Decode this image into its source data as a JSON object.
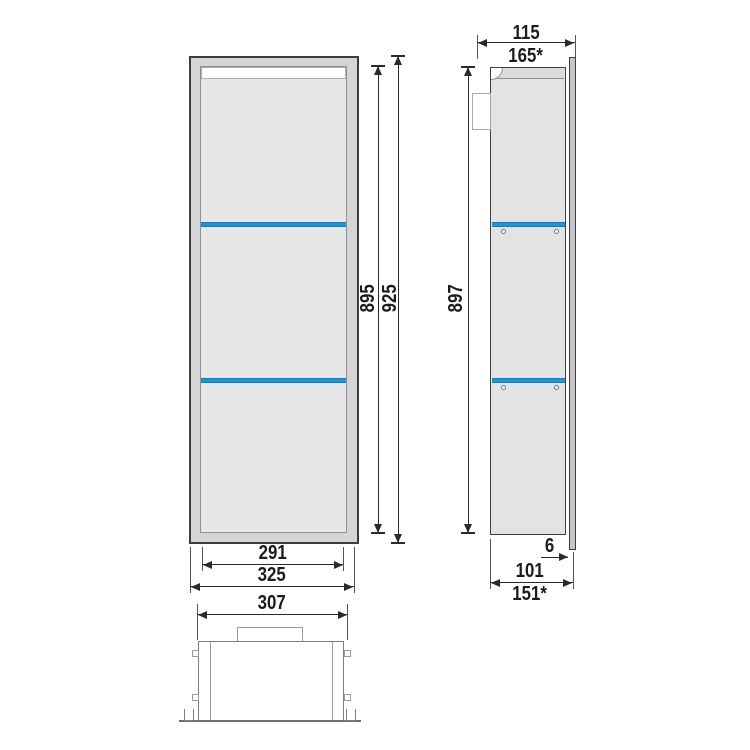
{
  "drawing": {
    "type": "technical-dimension-drawing",
    "views": {
      "front": {
        "inner_height": "895",
        "outer_height": "925",
        "inner_width": "291",
        "outer_width": "325"
      },
      "side": {
        "depth_top": "115",
        "depth_top_alt": "165*",
        "height": "897",
        "frame_protrusion": "6",
        "depth_bottom": "101",
        "depth_bottom_alt": "151*"
      },
      "top": {
        "width": "307"
      }
    },
    "shelf_count": 2,
    "colors": {
      "shelf_blue": "#1a97d5",
      "body_fill": "#e7e7e7",
      "frame_fill": "#d5d5d5",
      "outline": "#3e3e3e",
      "dimension": "#2a2a2a"
    }
  }
}
